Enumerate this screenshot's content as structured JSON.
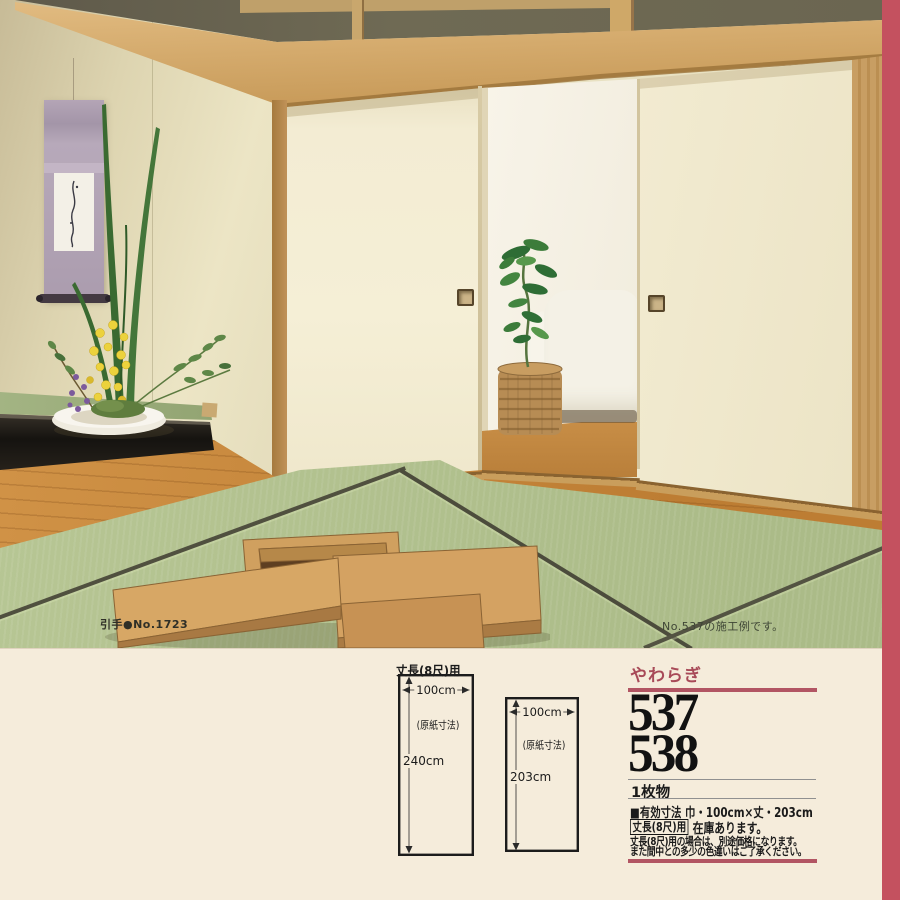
{
  "page": {
    "background": "#f5ecdb",
    "accent_pink": "#c4515f",
    "accent_rule": "#b25563"
  },
  "photo": {
    "caption_left": "引手●No.1723",
    "caption_right": "No.537の施工例です。"
  },
  "diagrams": {
    "title": "丈長(8尺)用",
    "items": [
      {
        "width_label": "100cm",
        "paper_label": "(原紙寸法)",
        "height_label": "240cm"
      },
      {
        "width_label": "100cm",
        "paper_label": "(原紙寸法)",
        "height_label": "203cm"
      }
    ]
  },
  "product": {
    "series_name": "やわらぎ",
    "code_1": "537",
    "code_2": "538",
    "sheet_type": "1枚物",
    "effective_size": "■有効寸法 巾・100cm×丈・203cm",
    "stock_badge": "丈長(8尺)用",
    "stock_text": "在庫あります。",
    "note_line1": "丈長(8尺)用の場合は、別途価格になります。",
    "note_line2": "また間中との多少の色違いはご了承ください。"
  }
}
